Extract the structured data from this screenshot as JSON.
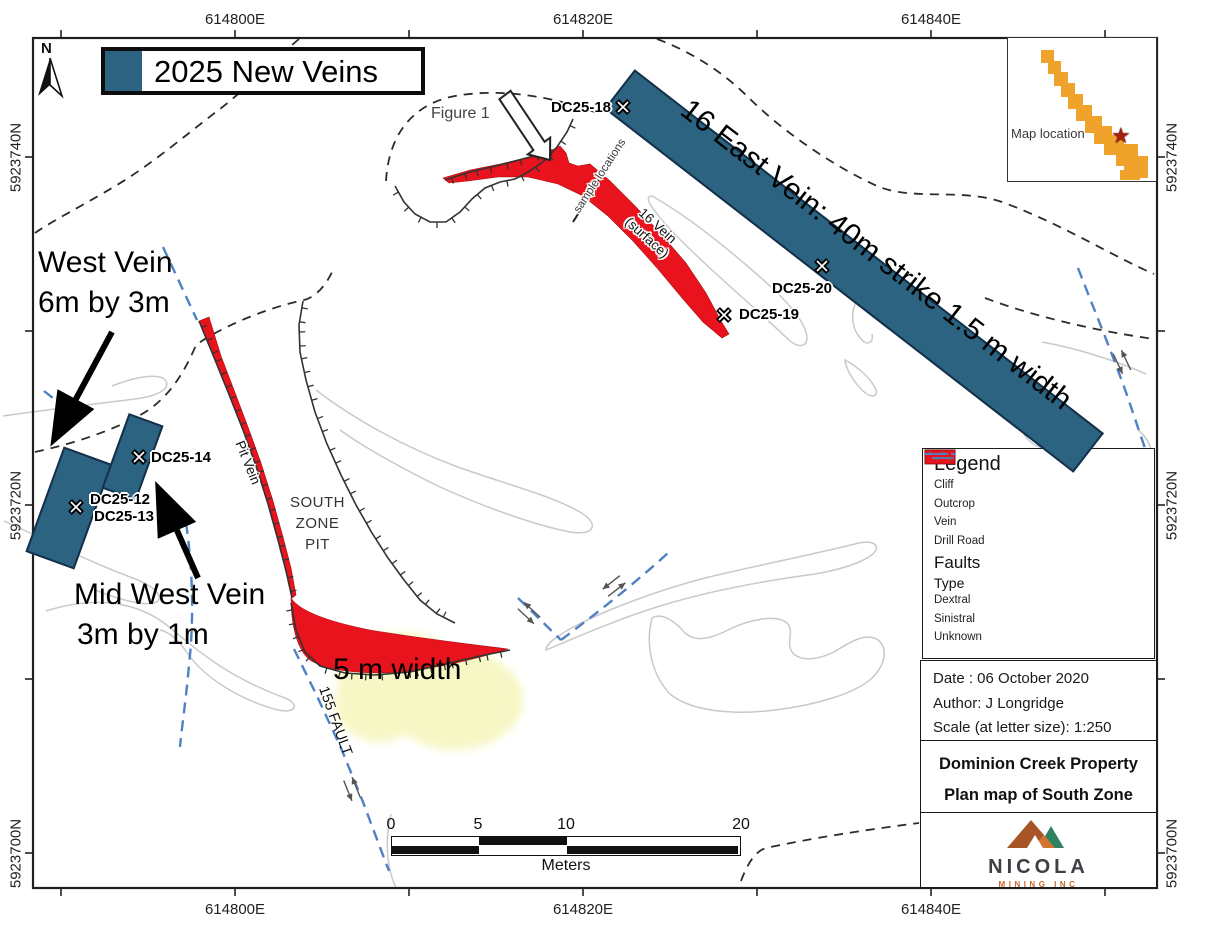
{
  "figure": {
    "north_label": "N",
    "new_veins_legend": {
      "label": "2025 New Veins",
      "color": "#2b6380"
    },
    "coordinates": {
      "top": [
        "614800E",
        "614820E",
        "614840E"
      ],
      "bottom": [
        "614800E",
        "614820E",
        "614840E"
      ],
      "left": [
        "5923740N",
        "5923720N",
        "5923700N"
      ],
      "right": [
        "5923740N",
        "5923720N",
        "5923700N"
      ]
    },
    "inset": {
      "label": "Map location",
      "star_icon": "star",
      "shape_color": "#efa32b",
      "star_color": "#a51f12"
    },
    "annotations": {
      "figure1": "Figure 1",
      "west_vein_line1": "West Vein",
      "west_vein_line2": "6m by 3m",
      "mid_west_line1": "Mid West Vein",
      "mid_west_line2": "3m by 1m",
      "width_note": "5 m width",
      "east_vein_note": "16 East Vein:  40m strike 1.5 m width",
      "sample_locations": "sample locations",
      "vein16_line1": "16 Vein",
      "vein16_line2": "(surface)",
      "pit_vein": "Pit Vein",
      "fault_155": "155 FAULT",
      "south_zone_pit_line1": "SOUTH",
      "south_zone_pit_line2": "ZONE",
      "south_zone_pit_line3": "PIT"
    },
    "drill_holes": [
      {
        "label": "DC25-18"
      },
      {
        "label": "DC25-20"
      },
      {
        "label": "DC25-19"
      },
      {
        "label": "DC25-14"
      },
      {
        "label": "DC25-12"
      },
      {
        "label": "DC25-13"
      }
    ],
    "scale_bar": {
      "tick0": "0",
      "tick5": "5",
      "tick10": "10",
      "tick20": "20",
      "unit": "Meters"
    },
    "legend": {
      "title": "Legend",
      "item_cliff": "Cliff",
      "item_outcrop": "Outcrop",
      "item_vein": "Vein",
      "item_drill_road": "Drill Road",
      "faults_title": "Faults",
      "type_title": "Type",
      "type_dextral": "Dextral",
      "type_sinistral": "Sinistral",
      "type_unknown": "Unknown"
    },
    "info": {
      "date": "Date : 06 October 2020",
      "author": "Author: J Longridge",
      "scale": "Scale (at letter size): 1:250",
      "property": "Dominion Creek Property",
      "map_title": "Plan map of South Zone"
    },
    "logo": {
      "name": "NICOLA",
      "sub": "MINING INC"
    },
    "colors": {
      "new_vein_teal": "#2b6380",
      "vein_red": "#e8131c",
      "fault_blue": "#4f81c5",
      "highlight_yellow": "#f7f7c6",
      "inset_orange": "#efa32b",
      "logo_orange": "#c9672c",
      "logo_green": "#2f8162"
    }
  }
}
